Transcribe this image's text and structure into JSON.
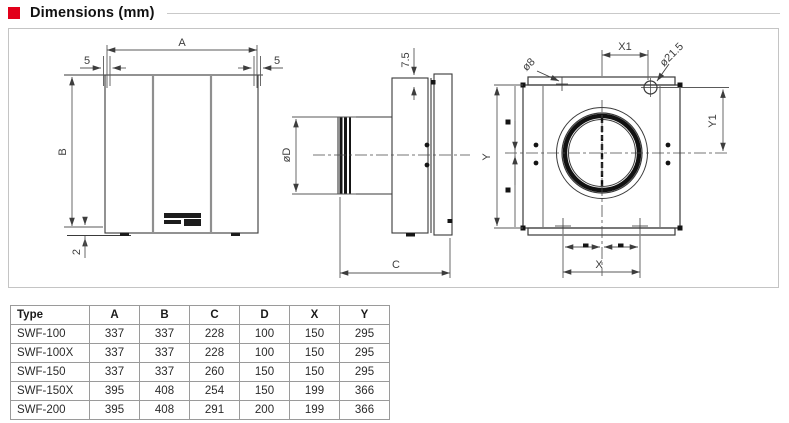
{
  "title": "Dimensions (mm)",
  "colors": {
    "accent": "#e2001a",
    "drawing_line": "#3a3a3a",
    "dimension_line": "#5a5a5a",
    "frame_border": "#c4c4c4",
    "table_border": "#9a9a9a"
  },
  "dims": {
    "A": "A",
    "B": "B",
    "C": "C",
    "D": "øD",
    "X": "X",
    "Y": "Y",
    "X1": "X1",
    "Y1": "Y1",
    "d8": "ø8",
    "d215": "ø21.5",
    "t75": "7.5",
    "five_left": "5",
    "five_right": "5",
    "two": "2"
  },
  "table": {
    "headers": [
      "Type",
      "A",
      "B",
      "C",
      "D",
      "X",
      "Y"
    ],
    "rows": [
      [
        "SWF-100",
        "337",
        "337",
        "228",
        "100",
        "150",
        "295"
      ],
      [
        "SWF-100X",
        "337",
        "337",
        "228",
        "100",
        "150",
        "295"
      ],
      [
        "SWF-150",
        "337",
        "337",
        "260",
        "150",
        "150",
        "295"
      ],
      [
        "SWF-150X",
        "395",
        "408",
        "254",
        "150",
        "199",
        "366"
      ],
      [
        "SWF-200",
        "395",
        "408",
        "291",
        "200",
        "199",
        "366"
      ]
    ]
  }
}
